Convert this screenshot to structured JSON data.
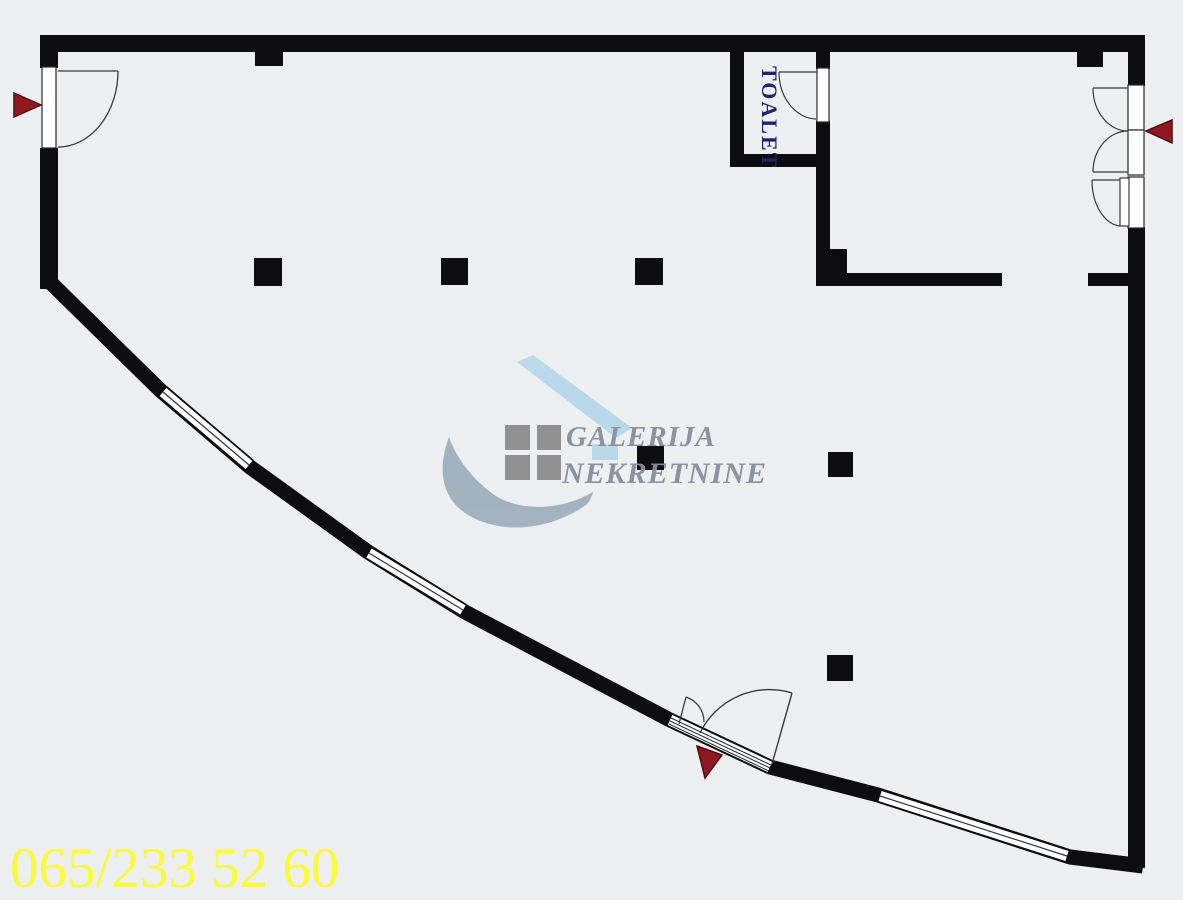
{
  "page": {
    "background_color": "#edeff1",
    "wall_color": "#0d0d0f",
    "door_line_color": "#3a3a3a"
  },
  "labels": {
    "toilet": "TOALET",
    "toilet_color": "#23226b"
  },
  "watermark": {
    "line1": "GALERIJA",
    "line2": "NEKRETNINE",
    "text_color": "#878e9a",
    "roof_color": "#b7d7e9",
    "swoosh_color": "#9fafbc",
    "square_color": "#8d8d8d",
    "accent_rect_color": "#b7d7e9"
  },
  "contact": {
    "phone": "065/233 52 60",
    "phone_color": "#fbfb3a"
  },
  "markers": {
    "entrance_arrow_color": "#8f1822",
    "entrance_arrow_edge": "#520b11",
    "entrance_count": "3"
  }
}
